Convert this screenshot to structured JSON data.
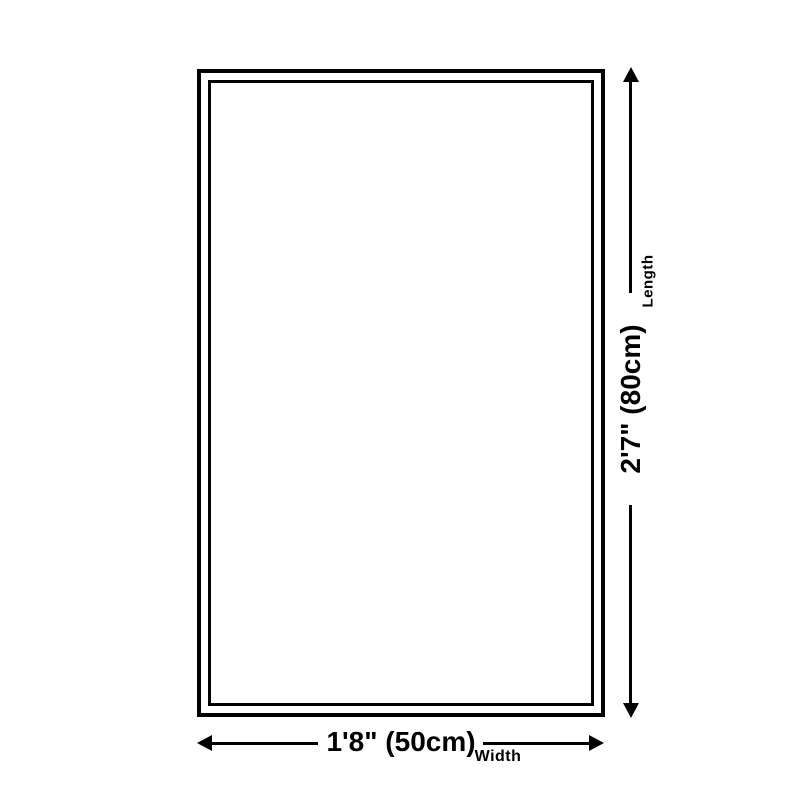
{
  "colors": {
    "background": "#ffffff",
    "line": "#000000",
    "text": "#000000"
  },
  "diagram": {
    "kind": "product-size-diagram",
    "length": {
      "value": "2'7\" (80cm)",
      "label": "Length"
    },
    "width": {
      "value": "1'8\" (50cm)",
      "label": "Width"
    }
  },
  "icons": {
    "up": "arrow-up-icon",
    "down": "arrow-down-icon",
    "left": "arrow-left-icon",
    "right": "arrow-right-icon"
  }
}
